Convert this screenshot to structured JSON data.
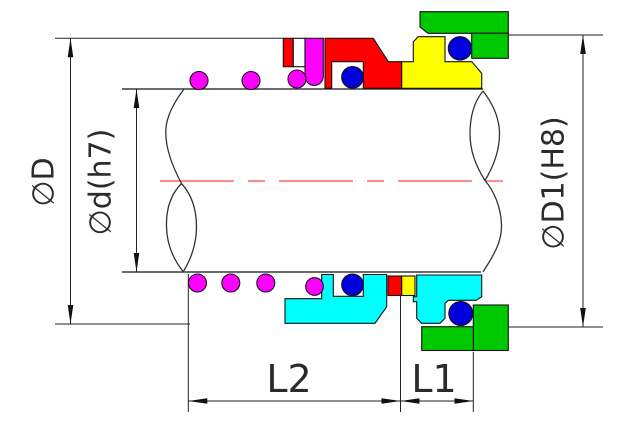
{
  "drawing": {
    "title": "mechanical seal cross-section engineering drawing",
    "dimension_labels": {
      "outer_diameter": "∅D",
      "shaft_diameter": "∅d(h7)",
      "bore_diameter": "∅D1(H8)",
      "length_l2": "L2",
      "length_l1": "L1"
    },
    "colors": {
      "background": "#ffffff",
      "outline": "#111111",
      "centerline": "#ff1414",
      "spring": "#ff00ff",
      "bellows": "#ff00ff",
      "seal_head": "#ff0000",
      "small_red": "#ff0000",
      "white_band": "#ffffff",
      "o_ring": "#0000dd",
      "seat_yellow": "#ffff00",
      "seat_cyan": "#00ffff",
      "gland_green": "#00c800",
      "dimension": "#222222"
    }
  }
}
